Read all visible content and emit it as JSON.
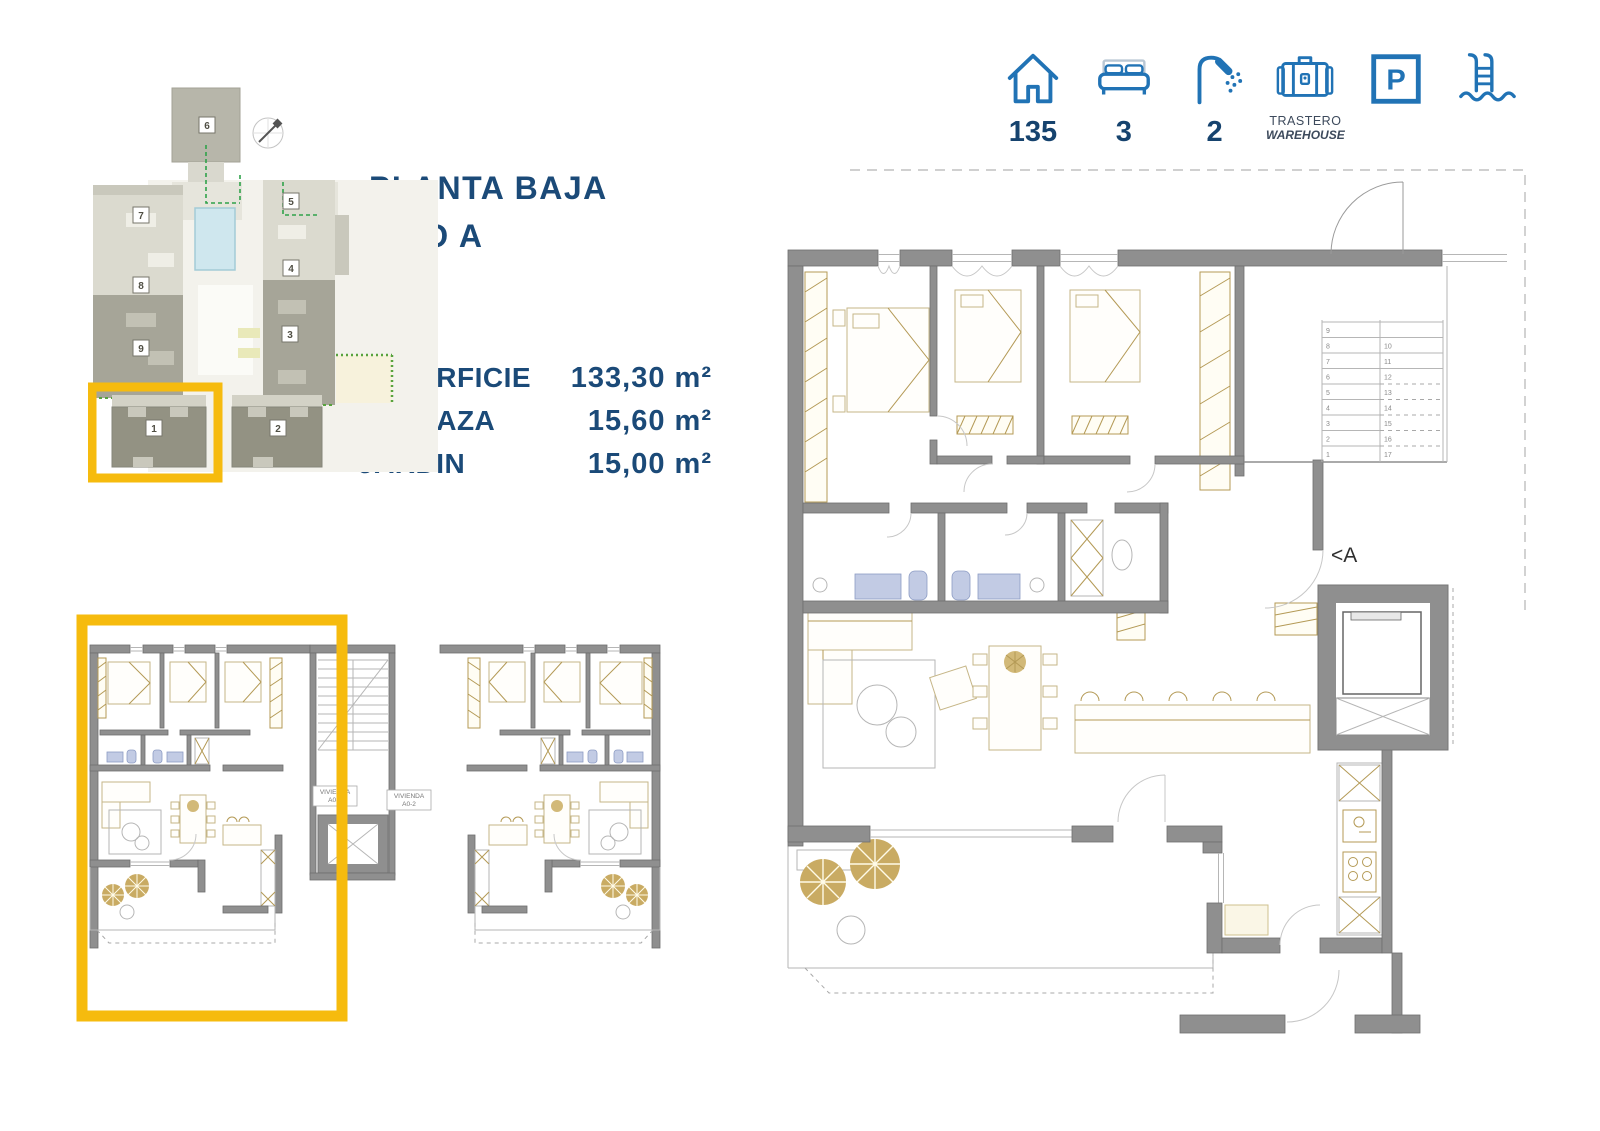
{
  "title": {
    "line1": "PLANTA BAJA",
    "line2": "TIPO A"
  },
  "specs": [
    {
      "label": "SUPERFICIE",
      "value": "133,30 m²"
    },
    {
      "label": "TERRAZA",
      "value": "15,60 m²"
    },
    {
      "label": "JARDIN",
      "value": "15,00 m²"
    }
  ],
  "amenities": {
    "items": [
      {
        "icon": "house-icon",
        "value": "135"
      },
      {
        "icon": "bed-icon",
        "value": "3"
      },
      {
        "icon": "shower-icon",
        "value": "2"
      },
      {
        "icon": "warehouse-icon",
        "label1": "TRASTERO",
        "label2": "WAREHOUSE"
      },
      {
        "icon": "parking-icon",
        "letter": "P"
      },
      {
        "icon": "pool-icon"
      }
    ]
  },
  "site_plan": {
    "units": {
      "b1": "1",
      "b2": "2",
      "b3": "3",
      "b4": "4",
      "b5": "5",
      "b6": "6",
      "b7": "7",
      "b8": "8",
      "b9": "9"
    },
    "highlight_color": "#f6bb0e"
  },
  "small_plan": {
    "unit1_line1": "VIVIENDA",
    "unit1_line2": "A0-1",
    "unit2_line1": "VIVIENDA",
    "unit2_line2": "A0-2"
  },
  "large_plan": {
    "entrance_label": "<A",
    "stairs_left": [
      "9",
      "8",
      "7",
      "6",
      "5",
      "4",
      "3",
      "2",
      "1"
    ],
    "stairs_right": [
      "10",
      "11",
      "12",
      "13",
      "14",
      "15",
      "16",
      "17"
    ]
  },
  "colors": {
    "navy_text": "#1b4a78",
    "icon_blue": "#2173b5",
    "highlight_yellow": "#f6bb0e",
    "wall_gray": "#8f8f8f",
    "fixture_blue": "#c2cbe4",
    "furniture_tan": "#c6b687",
    "pool_blue": "#cfe7ee"
  }
}
